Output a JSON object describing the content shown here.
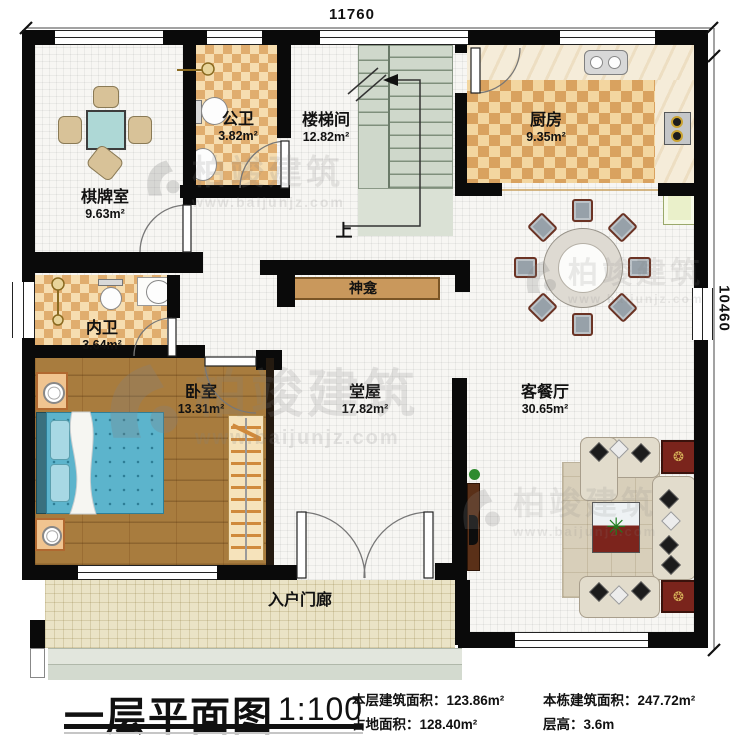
{
  "title_block": {
    "title": "一层平面图",
    "scale": "1:100",
    "stats": [
      {
        "text": "本层建筑面积：123.86m²"
      },
      {
        "text": "占地面积：128.40m²"
      },
      {
        "text": "本栋建筑面积：247.72m²"
      },
      {
        "text": "层高：3.6m"
      }
    ]
  },
  "dimensions": {
    "top": "11760",
    "right": "10460"
  },
  "rooms": [
    {
      "name": "棋牌室",
      "area": "9.63m²"
    },
    {
      "name": "公卫",
      "area": "3.82m²"
    },
    {
      "name": "楼梯间",
      "area": "12.82m²"
    },
    {
      "name": "厨房",
      "area": "9.35m²"
    },
    {
      "name": "内卫",
      "area": "3.64m²"
    },
    {
      "name": "卧室",
      "area": "13.31m²"
    },
    {
      "name": "堂屋",
      "area": "17.82m²"
    },
    {
      "name": "客餐厅",
      "area": "30.65m²"
    },
    {
      "name": "入户门廊",
      "area": ""
    }
  ],
  "labels": {
    "shrine": "神龛",
    "stairs_up": "上"
  },
  "watermark": {
    "brand": "柏竣建筑",
    "url": "www.baijunjz.com"
  }
}
